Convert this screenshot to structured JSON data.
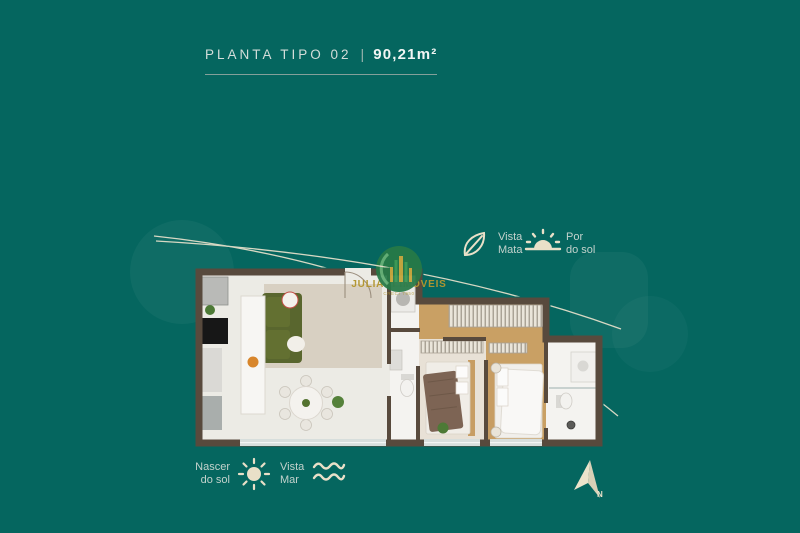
{
  "header": {
    "plan_label": "PLANTA TIPO 02",
    "separator": "|",
    "area_label": "90,21m²"
  },
  "features": {
    "forest_view": {
      "line1": "Vista",
      "line2": "Mata"
    },
    "sunset": {
      "line1": "Por",
      "line2": "do sol"
    },
    "sunrise": {
      "line1": "Nascer",
      "line2": "do sol"
    },
    "sea_view": {
      "line1": "Vista",
      "line2": "Mar"
    }
  },
  "watermark": {
    "brand": "JULIANI IMÓVEIS",
    "subtext": "CRECI 7950"
  },
  "compass": {
    "north_label": "N"
  },
  "colors": {
    "background": "#05665f",
    "accent_cream": "#e9e0c8",
    "label_text": "#c3d2cc",
    "title_text": "#d3ddd9",
    "title_bold": "#f2f6f4",
    "wall": "#584a3d",
    "wood_floor": "#c9a064",
    "sofa_green": "#59662e",
    "logo_gold": "#b3962f"
  }
}
